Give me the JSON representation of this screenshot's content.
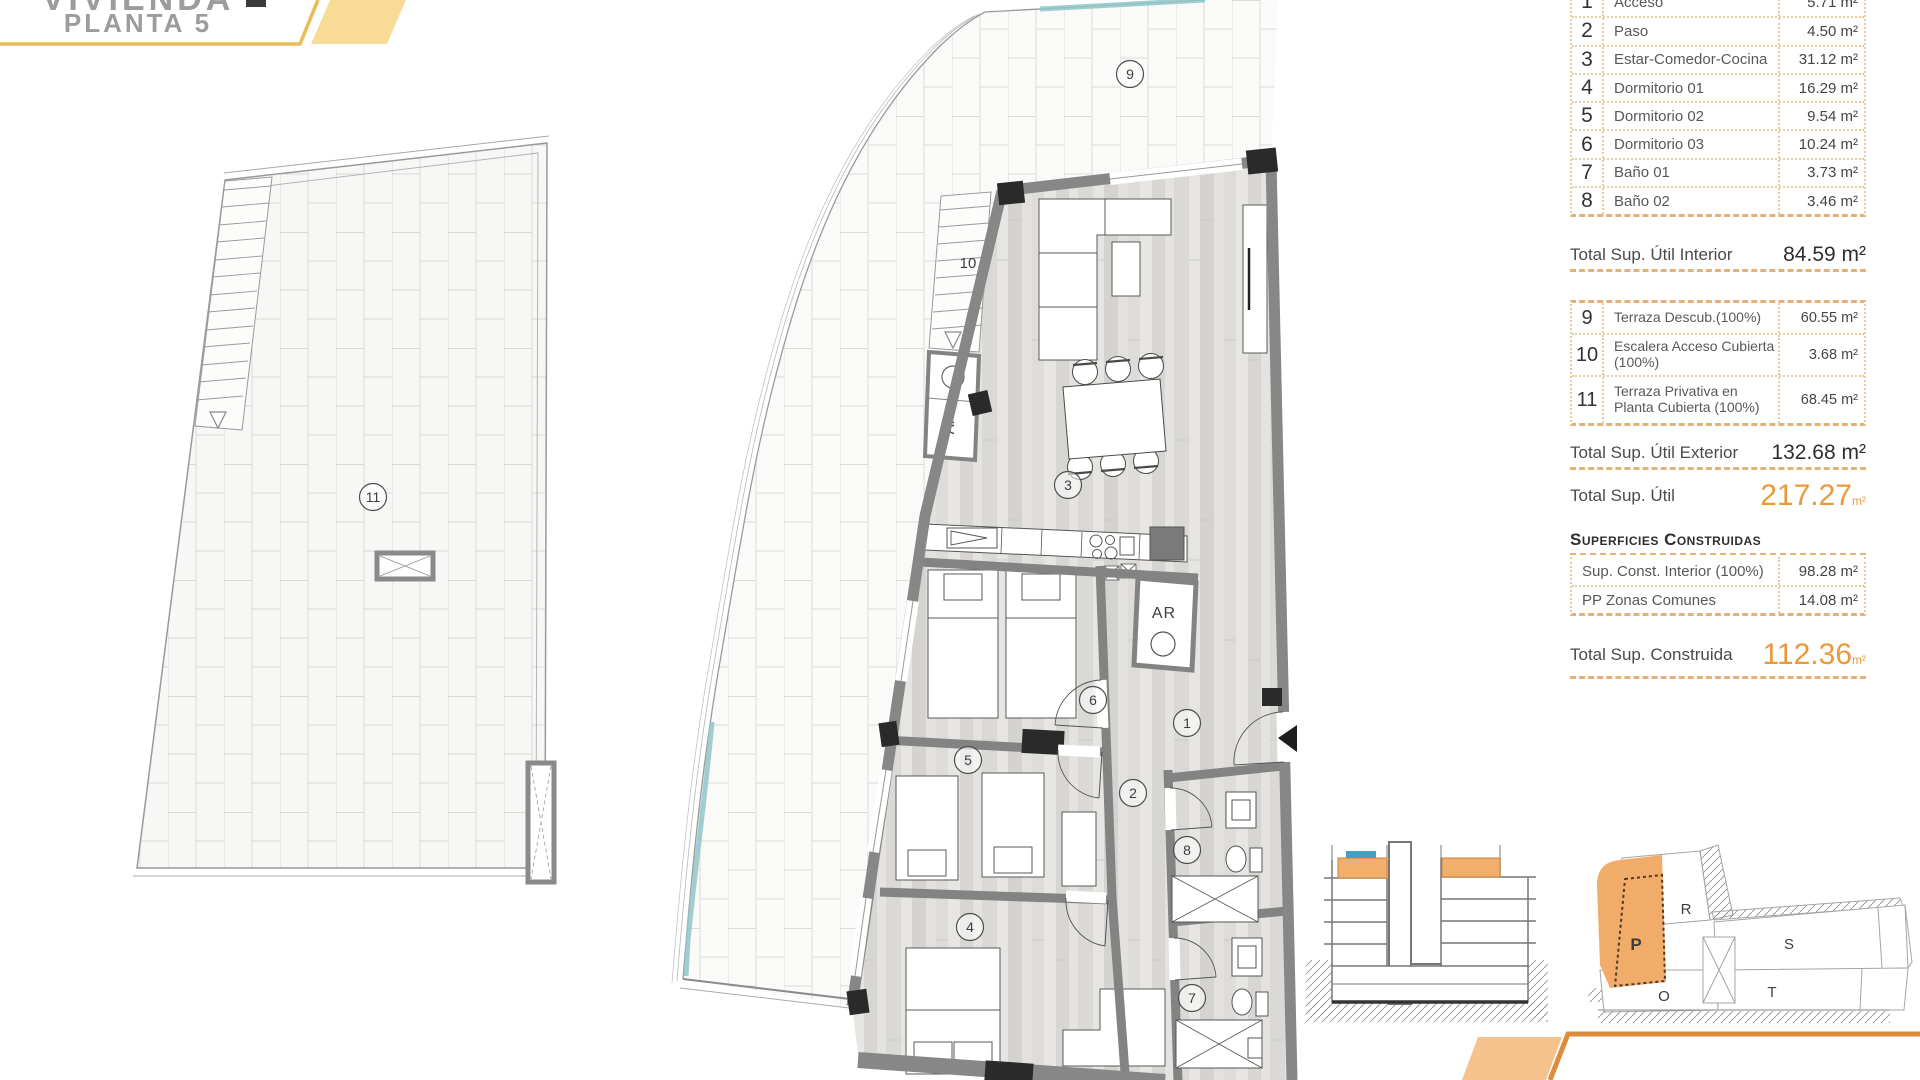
{
  "title": {
    "line1": "VIVIENDA",
    "line2": "PLANTA 5"
  },
  "surfaces_utiles": {
    "interior_rows": [
      {
        "num": "1",
        "name": "Acceso",
        "area": "5.71 m²"
      },
      {
        "num": "2",
        "name": "Paso",
        "area": "4.50 m²"
      },
      {
        "num": "3",
        "name": "Estar-Comedor-Cocina",
        "area": "31.12 m²"
      },
      {
        "num": "4",
        "name": "Dormitorio 01",
        "area": "16.29 m²"
      },
      {
        "num": "5",
        "name": "Dormitorio 02",
        "area": "9.54 m²"
      },
      {
        "num": "6",
        "name": "Dormitorio 03",
        "area": "10.24 m²"
      },
      {
        "num": "7",
        "name": "Baño 01",
        "area": "3.73 m²"
      },
      {
        "num": "8",
        "name": "Baño 02",
        "area": "3.46 m²"
      }
    ],
    "total_interior": {
      "label": "Total Sup. Útil Interior",
      "value": "84.59 m²"
    },
    "exterior_rows": [
      {
        "num": "9",
        "name": "Terraza Descub.(100%)",
        "area": "60.55 m²"
      },
      {
        "num": "10",
        "name": "Escalera Acceso Cubierta (100%)",
        "area": "3.68 m²"
      },
      {
        "num": "11",
        "name": "Terraza Privativa en Planta Cubierta (100%)",
        "area": "68.45 m²"
      }
    ],
    "total_exterior": {
      "label": "Total Sup. Útil Exterior",
      "value": "132.68 m²"
    },
    "total_util": {
      "label": "Total Sup. Útil",
      "value": "217.27",
      "unit": "m²"
    }
  },
  "superficies_construidas": {
    "header": "Superficies Construidas",
    "rows": [
      {
        "name": "Sup. Const. Interior (100%)",
        "area": "98.28 m²"
      },
      {
        "name": "PP Zonas Comunes",
        "area": "14.08 m²"
      }
    ],
    "total": {
      "label": "Total Sup. Construida",
      "value": "112.36",
      "unit": "m²"
    }
  },
  "plan": {
    "labels": {
      "acceso": "1",
      "paso": "2",
      "estar": "3",
      "dormitorio1": "4",
      "dormitorio2": "5",
      "dormitorio3": "6",
      "bano1": "7",
      "bano2": "8",
      "terraza_descubierta": "9",
      "escalera_acceso": "10",
      "terraza_privativa": "11"
    },
    "armario_stair": "AR",
    "armario_interior": "AR"
  },
  "site_plan": {
    "blocks": {
      "p": "P",
      "r": "R",
      "s": "S",
      "t": "T",
      "o": "O"
    },
    "highlighted": "P"
  },
  "colors": {
    "accent_orange": "#E8993B",
    "ribbon_yellow": "#EABC55",
    "ribbon_yellow_fill": "#F8DC96",
    "ribbon_orange": "#DD8B3D",
    "ribbon_orange_fill": "#F6C28E",
    "highlight_orange": "#F2AE6B",
    "highlight_blue": "#44A0C4",
    "table_border": "#E8CDA4"
  }
}
